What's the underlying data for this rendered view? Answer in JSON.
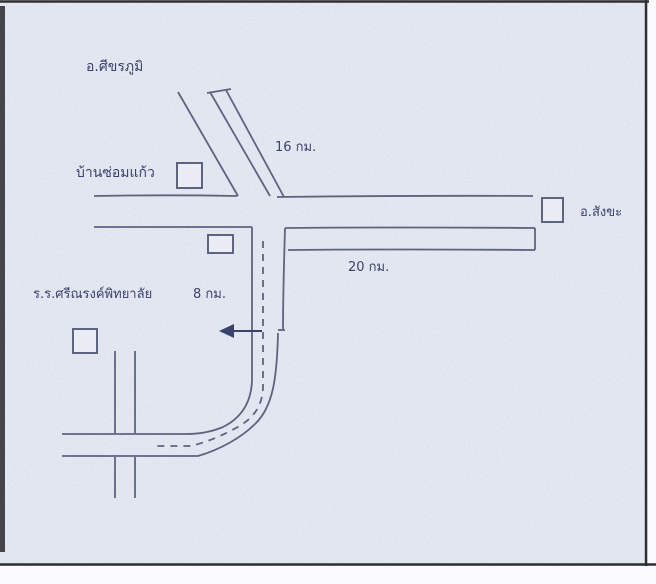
{
  "map": {
    "description": "Scanned hand-drawn route sketch map to a school",
    "colors": {
      "background": "#edeff5",
      "paper_white": "#fbfbfd",
      "road": "#5d6480",
      "ink": "#39426b",
      "frame": "#2e2e33"
    },
    "labels": {
      "district_top": "อ.ศีขรภูมิ",
      "distance_top": "16 กม.",
      "village": "บ้านซ่อมแก้ว",
      "district_right": "อ.สังขะ",
      "distance_right": "20 กม.",
      "school": "ร.ร.ศรีณรงค์พิทยาลัย",
      "distance_school": "8 กม."
    },
    "markers": {
      "village_box": "place-marker-square",
      "junction_box": "place-marker-square",
      "district_right_box": "place-marker-square",
      "school_box": "place-marker-square"
    },
    "route": {
      "style": "dashed-centerline-with-left-arrow"
    }
  }
}
